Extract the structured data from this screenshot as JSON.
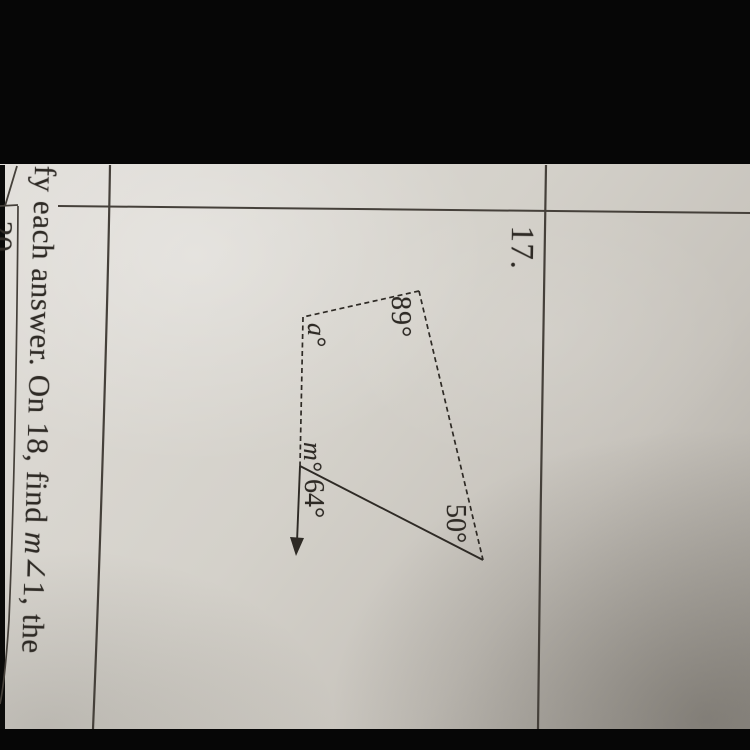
{
  "colors": {
    "bar": "#060606",
    "paper_light": "#e0ddd8",
    "paper_mid": "#d4d1ca",
    "paper_dark": "#a9a59e",
    "ink": "#2e2a25",
    "line": "#45403a"
  },
  "worksheet": {
    "problem_number": "17.",
    "next_problem_number": "20",
    "footer": {
      "pre": "fy each answer. On 18, find ",
      "var": "m",
      "post": "∠1, the"
    },
    "figure": {
      "labels": {
        "angle89": "89°",
        "angleA": "a°",
        "angleM": "m°",
        "angle64": "64°",
        "angle50": "50°"
      }
    }
  }
}
